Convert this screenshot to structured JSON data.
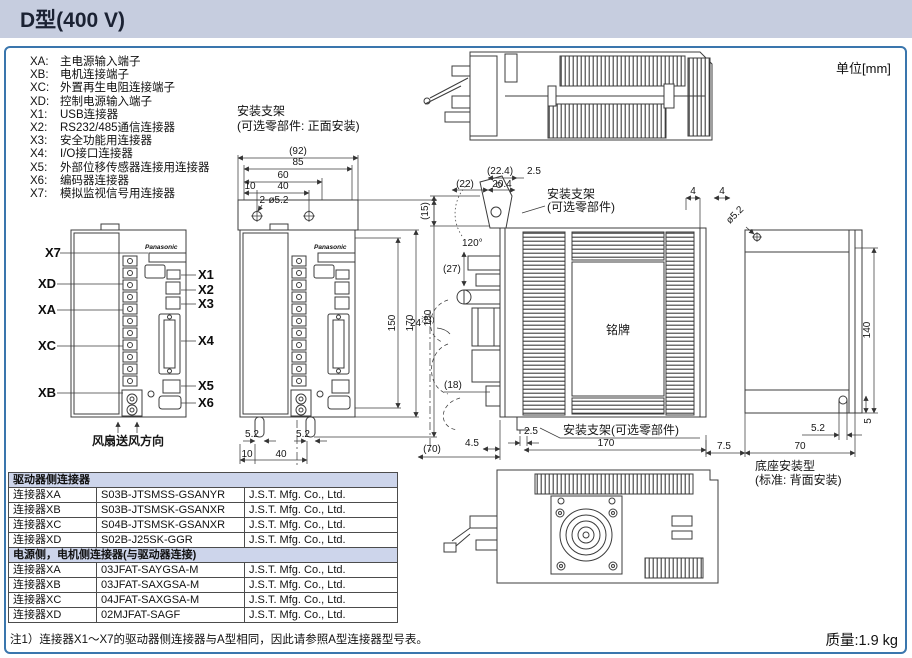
{
  "title": "D型(400 V)",
  "unit_label": "单位[mm]",
  "connector_legend": [
    {
      "code": "XA:",
      "label": "主电源输入端子"
    },
    {
      "code": "XB:",
      "label": "电机连接端子"
    },
    {
      "code": "XC:",
      "label": "外置再生电阻连接端子"
    },
    {
      "code": "XD:",
      "label": "控制电源输入端子"
    },
    {
      "code": "X1:",
      "label": "USB连接器"
    },
    {
      "code": "X2:",
      "label": "RS232/485通信连接器"
    },
    {
      "code": "X3:",
      "label": "安全功能用连接器"
    },
    {
      "code": "X4:",
      "label": "I/O接口连接器"
    },
    {
      "code": "X5:",
      "label": "外部位移传感器连接用连接器"
    },
    {
      "code": "X6:",
      "label": "编码器连接器"
    },
    {
      "code": "X7:",
      "label": "模拟监视信号用连接器"
    }
  ],
  "front_bracket_note": {
    "line1": "安装支架",
    "line2": "(可选零部件: 正面安装)"
  },
  "front_view": {
    "brand": "Panasonic",
    "left_labels": [
      "X7",
      "XD",
      "XA",
      "XC",
      "XB"
    ],
    "right_labels": [
      "X1",
      "X2",
      "X3",
      "X4",
      "X5",
      "X6"
    ],
    "fan_direction": "风扇送风方向"
  },
  "dim_view": {
    "top": {
      "w92": "(92)",
      "w85": "85",
      "w60": "60",
      "w10": "10",
      "w40": "40",
      "holes": "2-ø5.2"
    },
    "right": {
      "h150": "150",
      "h170": "170",
      "h180": "180"
    },
    "bottom": {
      "s1": "5.2",
      "s2": "5.2",
      "b10": "10",
      "b40": "40"
    }
  },
  "side_view": {
    "bracket_label": {
      "line1": "安装支架",
      "line2": "(可选零部件)"
    },
    "bracket_label_bottom": "安装支架(可选零部件)",
    "nameplate": "铭牌",
    "dims": {
      "d22_4": "(22.4)",
      "d2_5top": "2.5",
      "d22": "(22)",
      "d20_4": "20.4",
      "d15": "(15)",
      "angle": "120°",
      "d27": "(27)",
      "d24": "24",
      "d24sup": "注1)",
      "d18": "(18)",
      "d4_5": "4.5",
      "d70": "(70)",
      "d2_5": "2.5",
      "d170": "170"
    }
  },
  "rear_view": {
    "dims": {
      "d4a": "4",
      "d4b": "4",
      "dia": "ø5.2",
      "d140": "140",
      "d5_2": "5.2",
      "d5": "5",
      "d7_5": "7.5",
      "d70": "70"
    },
    "caption": {
      "line1": "底座安装型",
      "line2": "(标准: 背面安装)"
    }
  },
  "table": {
    "sections": [
      {
        "header": "驱动器侧连接器",
        "rows": [
          [
            "连接器XA",
            "S03B-JTSMSS-GSANYR",
            "J.S.T. Mfg. Co., Ltd."
          ],
          [
            "连接器XB",
            "S03B-JTSMSK-GSANXR",
            "J.S.T. Mfg. Co., Ltd."
          ],
          [
            "连接器XC",
            "S04B-JTSMSK-GSANXR",
            "J.S.T. Mfg. Co., Ltd."
          ],
          [
            "连接器XD",
            "S02B-J25SK-GGR",
            "J.S.T. Mfg. Co., Ltd."
          ]
        ]
      },
      {
        "header": "电源侧，电机侧连接器(与驱动器连接)",
        "rows": [
          [
            "连接器XA",
            "03JFAT-SAYGSA-M",
            "J.S.T. Mfg. Co., Ltd."
          ],
          [
            "连接器XB",
            "03JFAT-SAXGSA-M",
            "J.S.T. Mfg. Co., Ltd."
          ],
          [
            "连接器XC",
            "04JFAT-SAXGSA-M",
            "J.S.T. Mfg. Co., Ltd."
          ],
          [
            "连接器XD",
            "02MJFAT-SAGF",
            "J.S.T. Mfg. Co., Ltd."
          ]
        ]
      }
    ]
  },
  "note": "注1）连接器X1～X7的驱动器侧连接器与A型相同，因此请参照A型连接器型号表。",
  "mass": "质量:1.9 kg"
}
